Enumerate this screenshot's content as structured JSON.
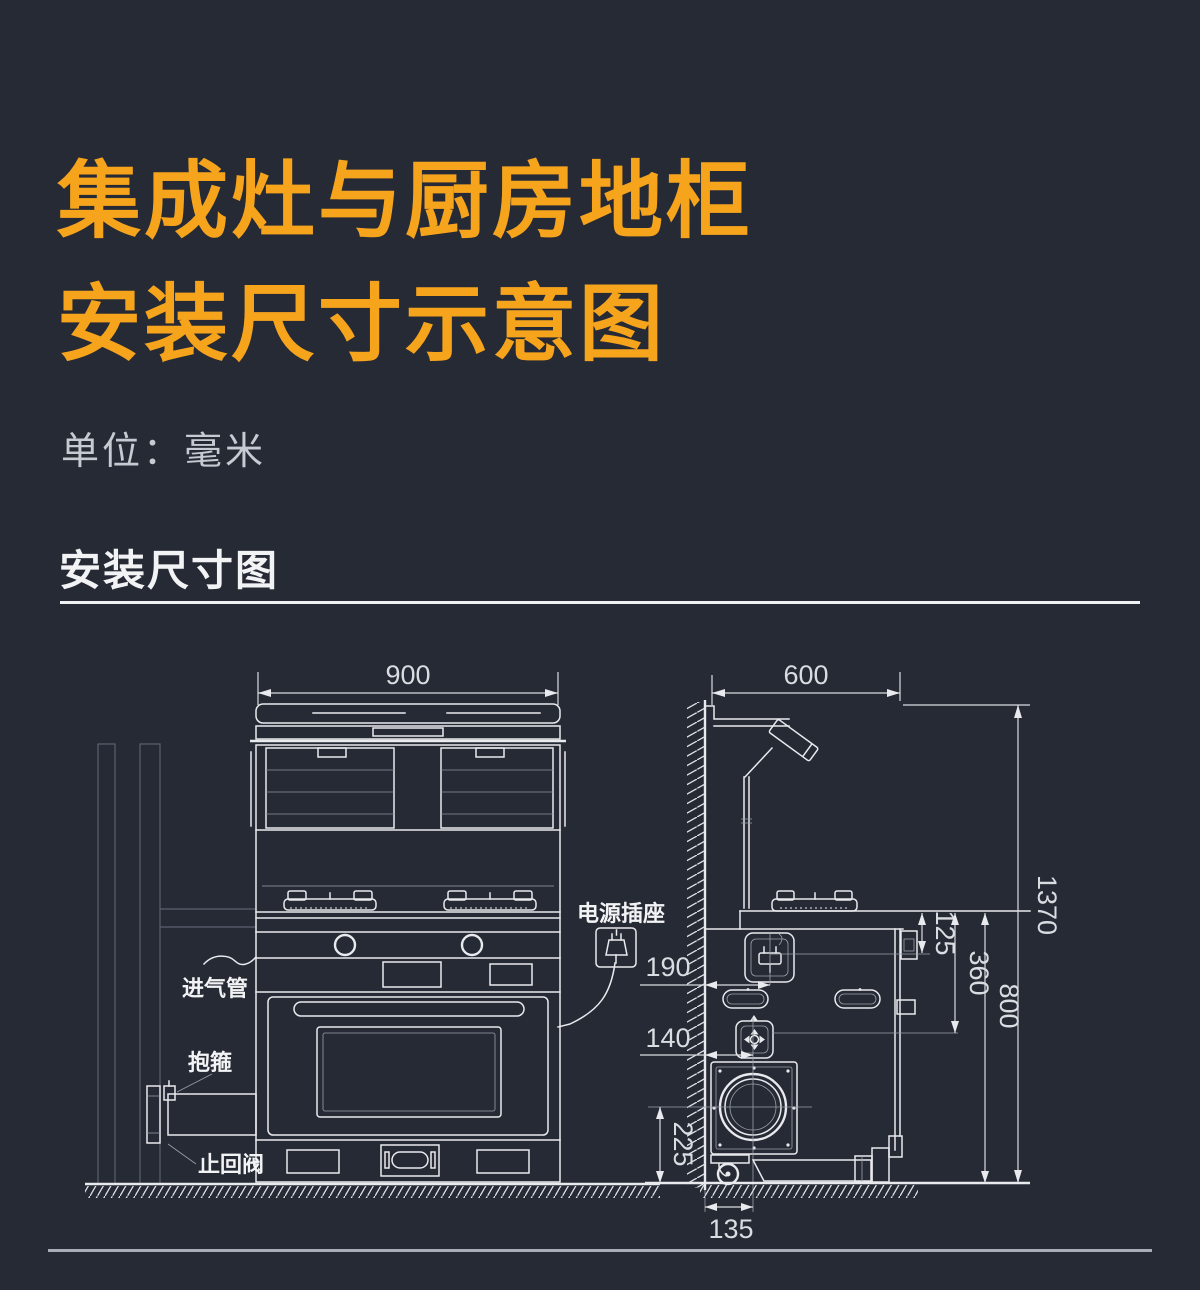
{
  "header": {
    "title_line1": "集成灶与厨房地柜",
    "title_line2": "安装尺寸示意图",
    "unit_label": "单位：毫米"
  },
  "section": {
    "heading": "安装尺寸图"
  },
  "colors": {
    "background": "#262A35",
    "accent_orange": "#F7A41D",
    "line_art": "#E8EAEE",
    "dim_text": "#D9DCE1",
    "muted_line": "#5A6170"
  },
  "front_view": {
    "dimensions": {
      "stove_width": "900"
    },
    "labels": {
      "gas_pipe": "进气管",
      "clamp": "抱箍",
      "check_valve": "止回阀",
      "power_socket": "电源插座"
    }
  },
  "side_view": {
    "dimensions": {
      "hood_depth": "600",
      "total_height": "1370",
      "counter_height": "800",
      "socket_below_counter": "125",
      "gas_inlet_below_counter": "360",
      "socket_from_wall": "190",
      "gas_inlet_from_wall": "140",
      "fan_center_above_floor": "225",
      "fan_center_from_wall": "135"
    }
  }
}
